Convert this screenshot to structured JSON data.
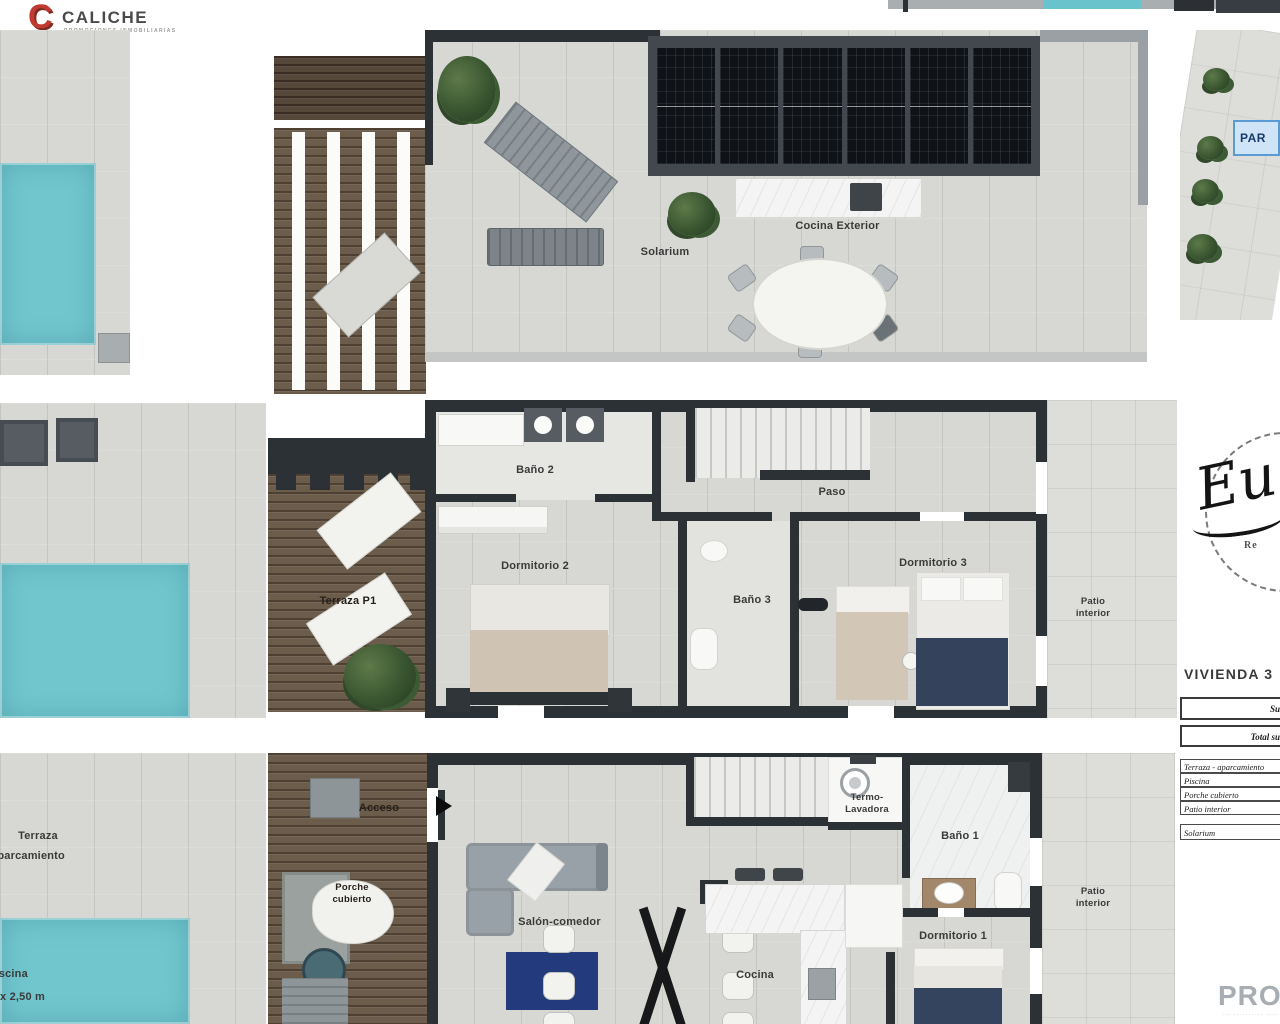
{
  "brand": {
    "name": "CALICHE",
    "tagline": "PROMOCIONES INMOBILIARIAS"
  },
  "site_plan": {
    "parking_label": "PAR"
  },
  "roof_plan": {
    "solarium": "Solarium",
    "outdoor_kitchen": "Cocina Exterior"
  },
  "first_floor": {
    "bath2": "Baño 2",
    "bedroom2": "Dormitorio 2",
    "hall": "Paso",
    "bath3": "Baño 3",
    "bedroom3": "Dormitorio 3",
    "terrace": "Terraza P1",
    "patio": "Patio\ninterior"
  },
  "ground_floor": {
    "access": "Acceso",
    "terrace_line1": "Terraza",
    "terrace_line2": "aparcamiento",
    "porch": "Porche\ncubierto",
    "living": "Salón-comedor",
    "kitchen": "Cocina",
    "utility": "Termo-\nLavadora",
    "bath1": "Baño 1",
    "bedroom1": "Dormitorio 1",
    "patio": "Patio\ninterior",
    "pool_name": "Piscina",
    "pool_size": "x 2,50 m"
  },
  "info_panel": {
    "title": "VIVIENDA 3",
    "summary_row1": "Su",
    "summary_row2": "Total su",
    "area_rows": [
      "Terraza - aparcamiento",
      "Piscina",
      "Porche cubierto",
      "Patio interior"
    ],
    "solarium_row": "Solarium"
  },
  "watermark": {
    "initials": "Eu",
    "subtext": "Re"
  },
  "footer": {
    "brand_fragment": "PROP",
    "tagline_fragment": "··· ·········· ····"
  },
  "colors": {
    "pool": "#71c6ce",
    "wall": "#2c3136",
    "wood": "#6b5c4b",
    "accent_red": "#bf3a30",
    "parking_blue": "#5b9bd5"
  }
}
